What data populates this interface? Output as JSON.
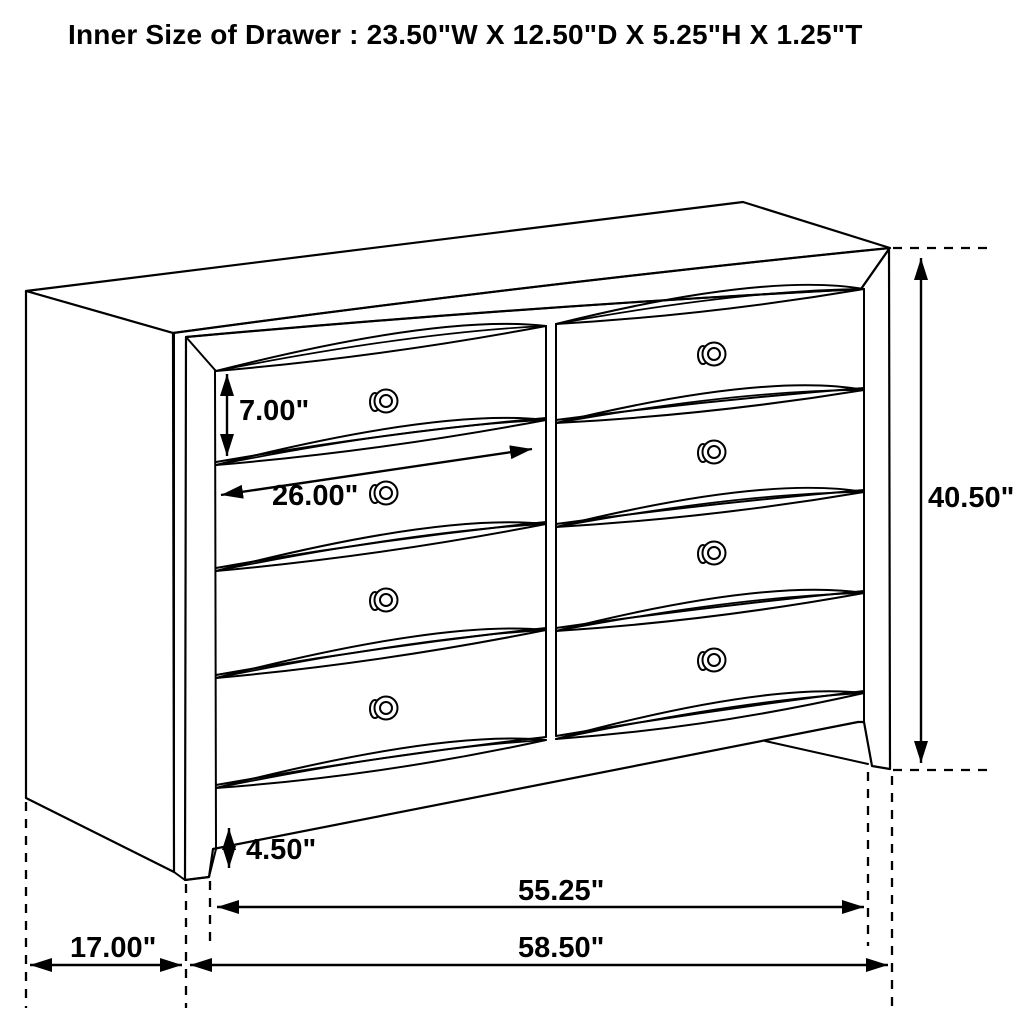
{
  "header": {
    "title": "Inner Size of Drawer : 23.50\"W X 12.50\"D X 5.25\"H X 1.25\"T"
  },
  "diagram": {
    "type": "furniture-dimension-line-drawing",
    "item": "dresser with 8 drawers (2 columns x 4 rows), round knobs, wave-carved drawer fronts",
    "inner_drawer_size": {
      "width": "23.50\"W",
      "depth": "12.50\"D",
      "height": "5.25\"H",
      "thickness": "1.25\"T"
    },
    "dim_labels": {
      "drawer_face_height": "7.00\"",
      "drawer_face_width": "26.00\"",
      "overall_height": "40.50\"",
      "base_height": "4.50\"",
      "width_between_feet": "55.25\"",
      "overall_width": "58.50\"",
      "side_depth": "17.00\""
    },
    "colors": {
      "background": "#ffffff",
      "line": "#000000",
      "text": "#000000"
    }
  }
}
